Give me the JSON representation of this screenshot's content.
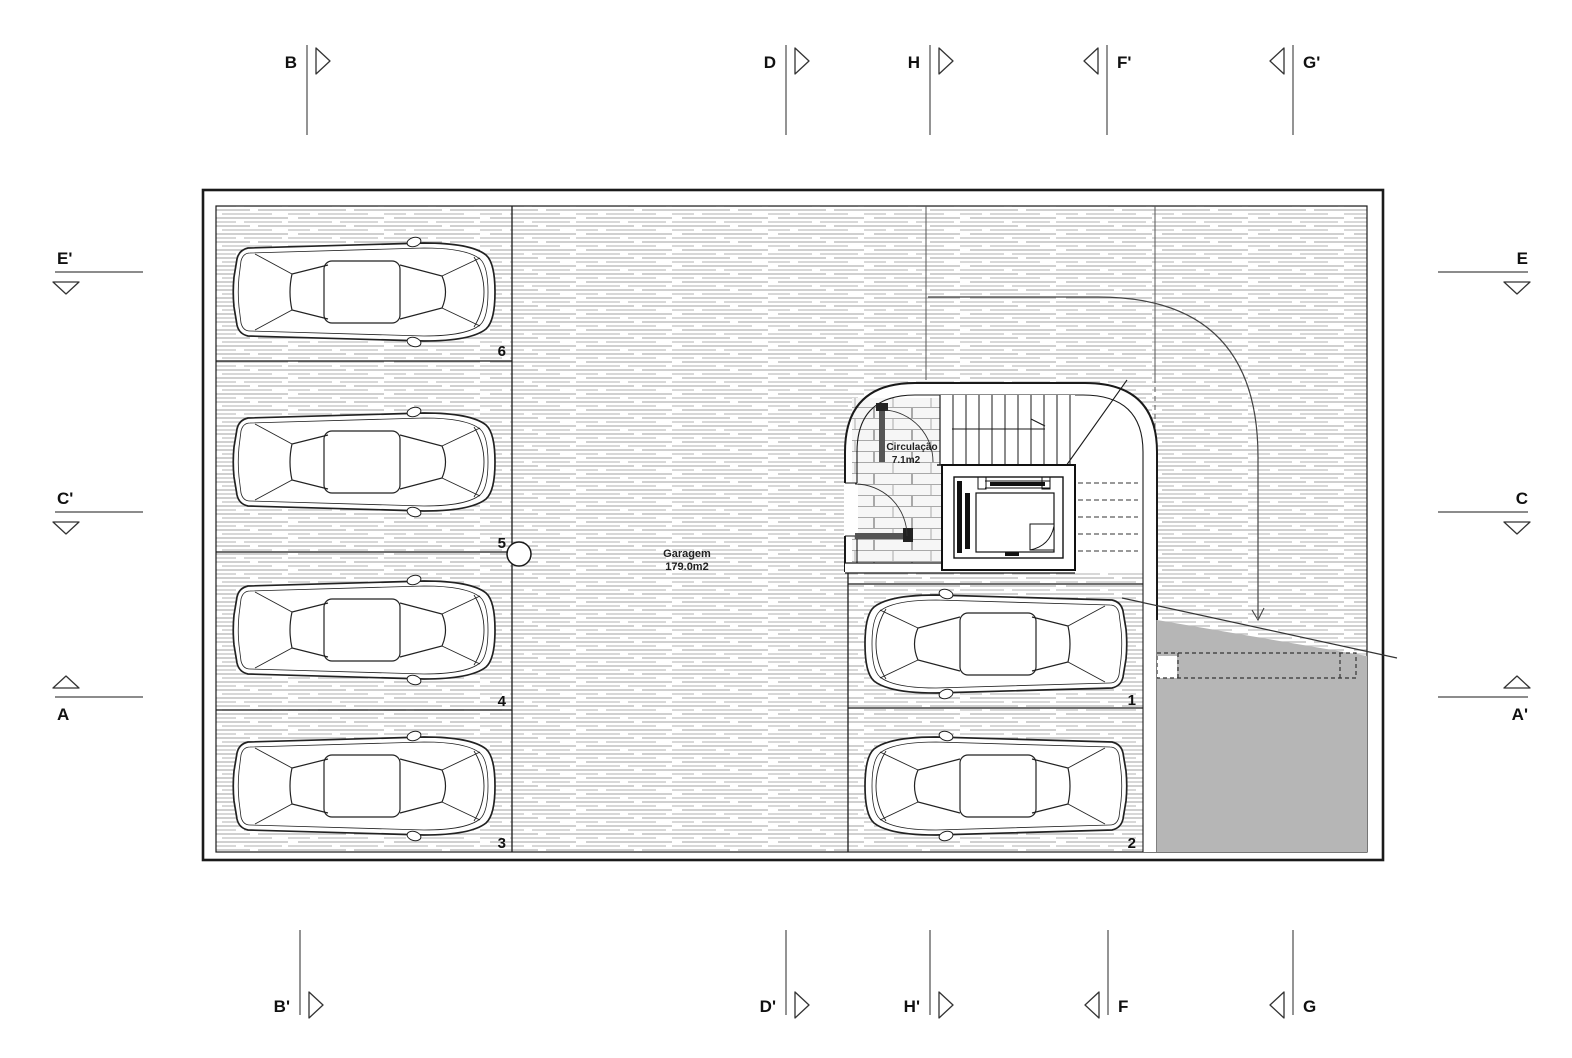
{
  "drawing": {
    "rooms": {
      "garage": {
        "name": "Garagem",
        "area": "179.0m2"
      },
      "circulation": {
        "name": "Circulação",
        "area": "7.1m2"
      }
    },
    "parking_spaces": {
      "s1": "1",
      "s2": "2",
      "s3": "3",
      "s4": "4",
      "s5": "5",
      "s6": "6"
    }
  },
  "section_markers": {
    "top": [
      {
        "label": "B"
      },
      {
        "label": "D"
      },
      {
        "label": "H"
      },
      {
        "label": "F'"
      },
      {
        "label": "G'"
      }
    ],
    "bottom": [
      {
        "label": "B'"
      },
      {
        "label": "D'"
      },
      {
        "label": "H'"
      },
      {
        "label": "F"
      },
      {
        "label": "G"
      }
    ],
    "left": [
      {
        "label": "E'"
      },
      {
        "label": "C'"
      },
      {
        "label": "A"
      }
    ],
    "right": [
      {
        "label": "E"
      },
      {
        "label": "C"
      },
      {
        "label": "A'"
      }
    ]
  },
  "colors": {
    "line": "#1a1a1a",
    "floor_hatch": "#b5b5b5",
    "ramp_fill": "#b6b6b6",
    "marker_line": "#666666"
  }
}
